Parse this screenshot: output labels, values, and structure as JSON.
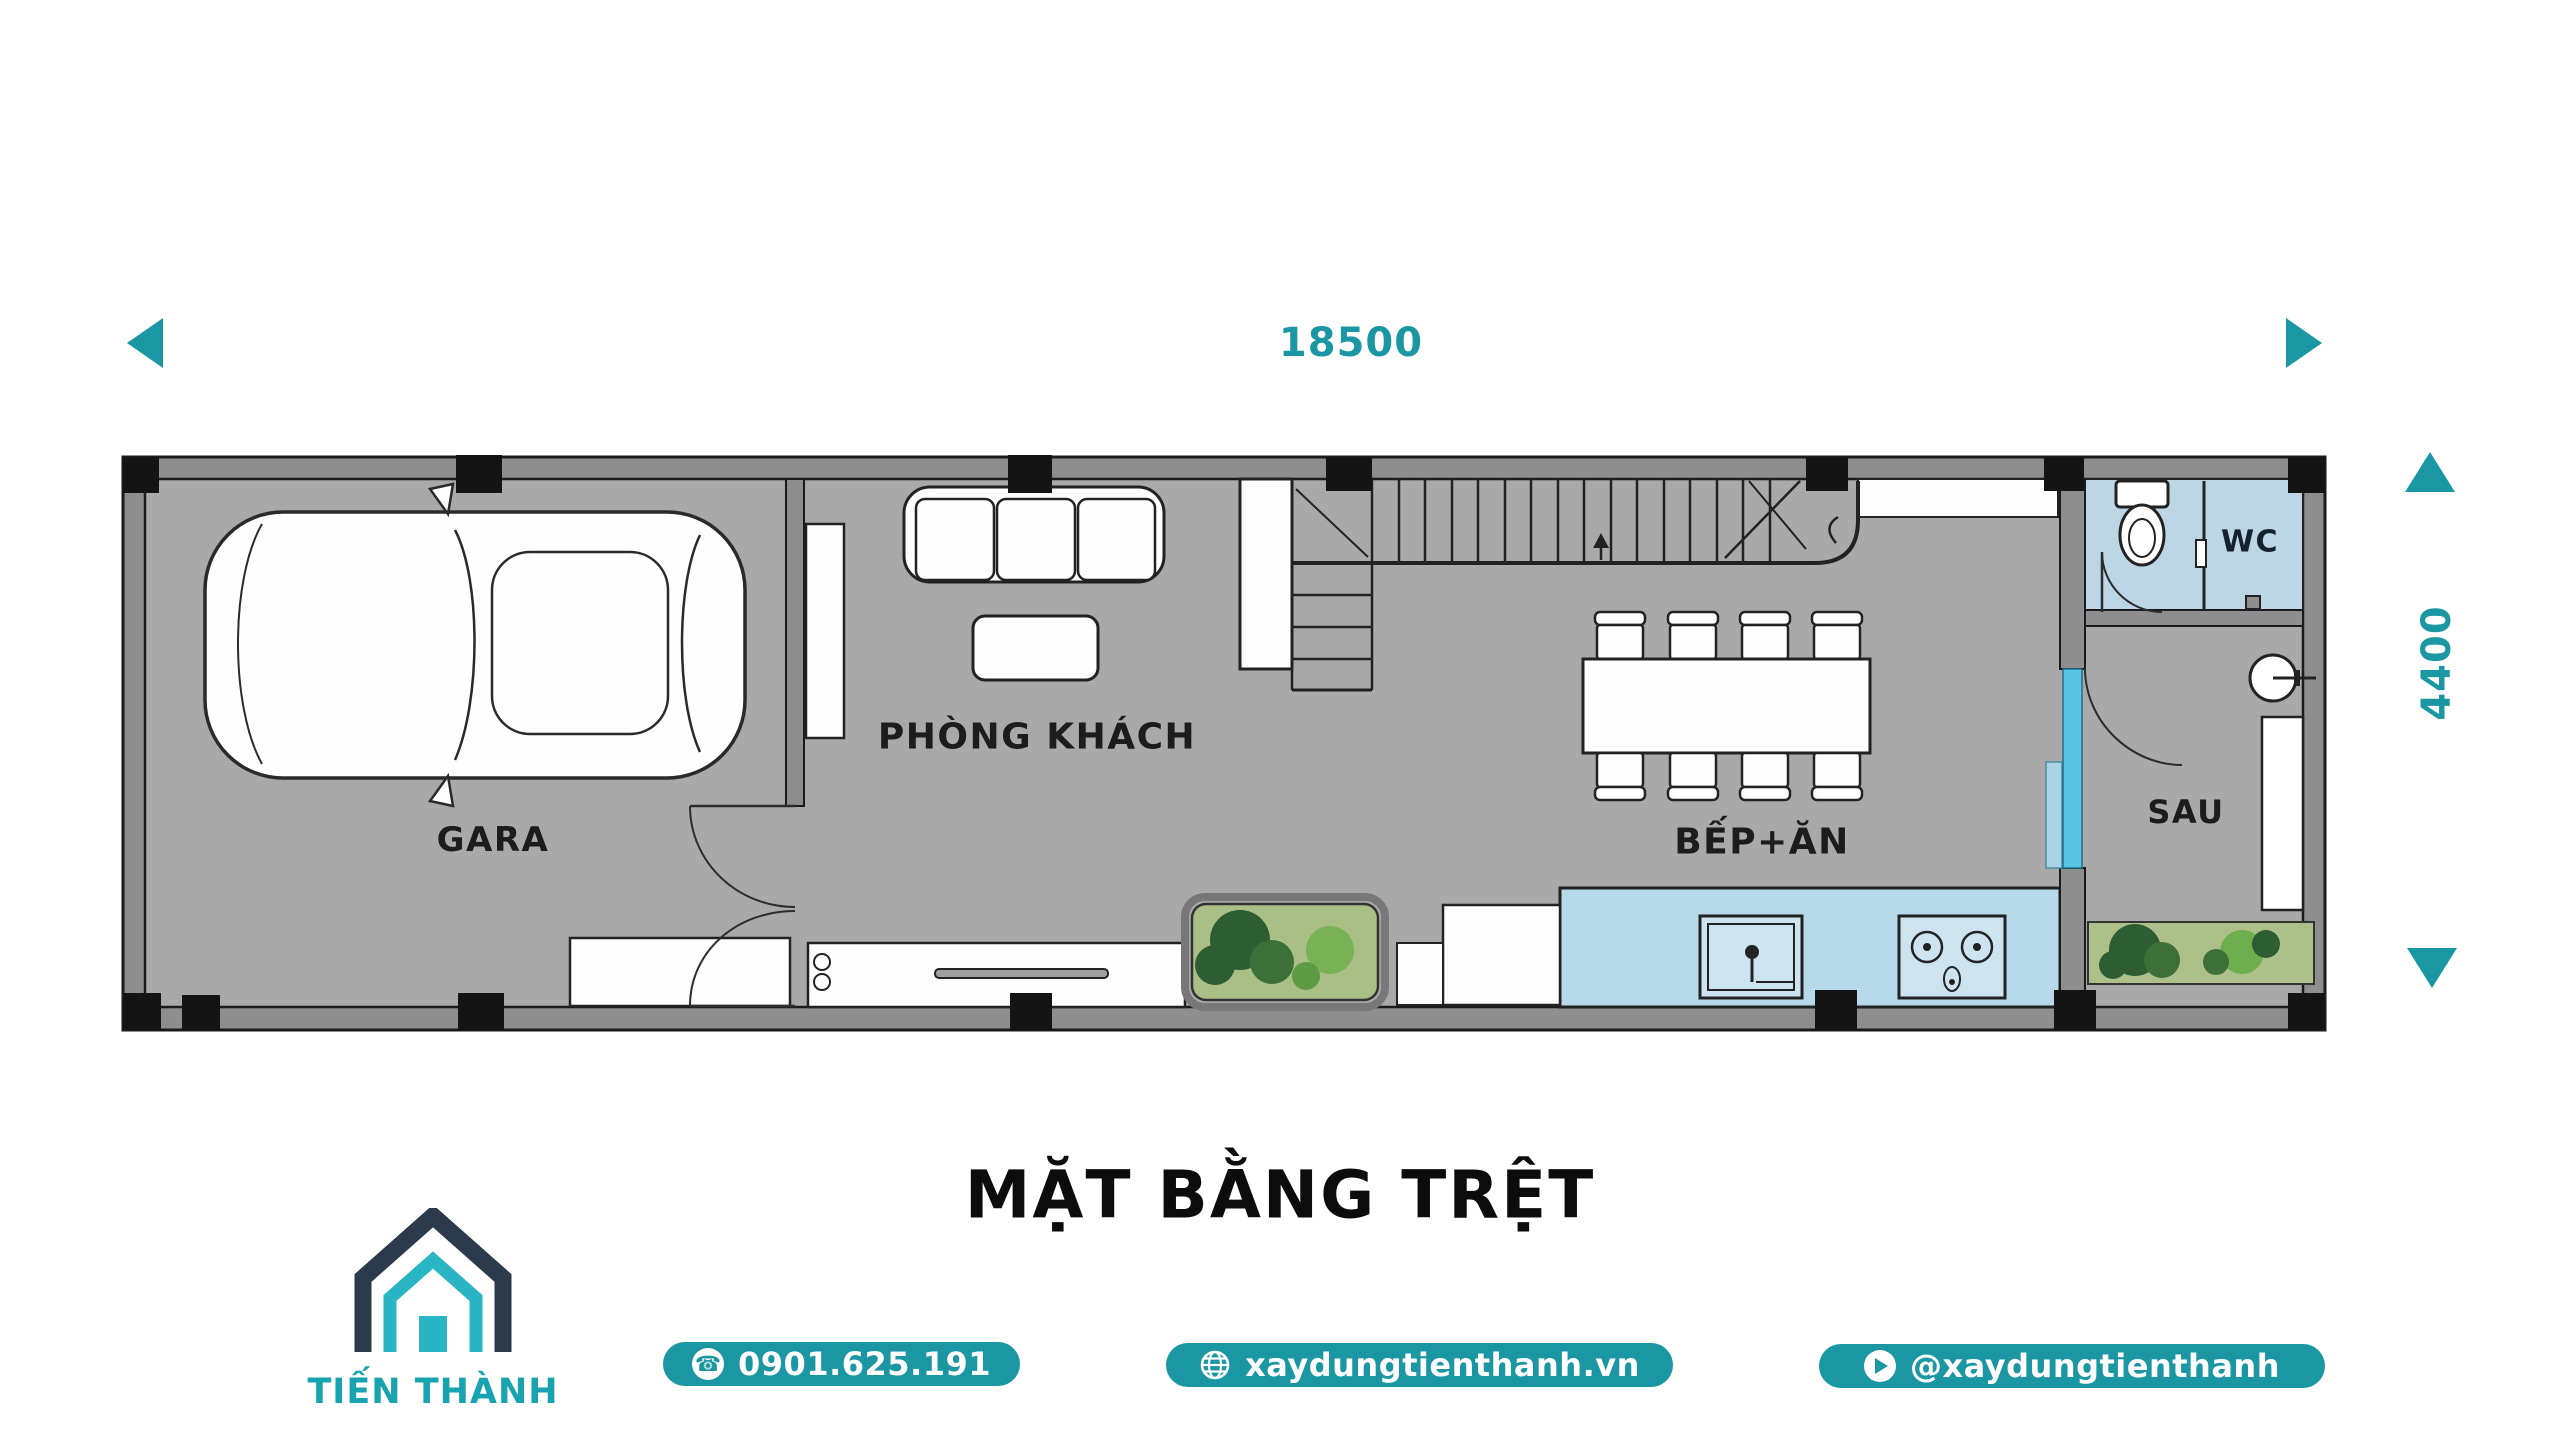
{
  "plan": {
    "dim_width": "18500",
    "dim_depth": "4400",
    "title": "MẶT BẰNG TRỆT",
    "rooms": {
      "garage": "GARA",
      "living": "PHÒNG KHÁCH",
      "kitchen_dining": "BẾP+ĂN",
      "wc": "WC",
      "back": "SAU"
    }
  },
  "brand": {
    "name": "TIẾN THÀNH"
  },
  "contact": {
    "phone": "0901.625.191",
    "website": "xaydungtienthanh.vn",
    "youtube": "@xaydungtienthanh"
  },
  "colors": {
    "accent_teal": "#1a97a2",
    "logo_teal": "#29b5c3",
    "logo_navy": "#2b3b4c",
    "floor_gray": "#a9a9a9",
    "wall_gray": "#8e8e8e",
    "wc_blue": "#bcd6e6",
    "counter_blue": "#b7d9e9",
    "glass_blue": "#58c5e5",
    "planter_green": "#a9bf85"
  }
}
